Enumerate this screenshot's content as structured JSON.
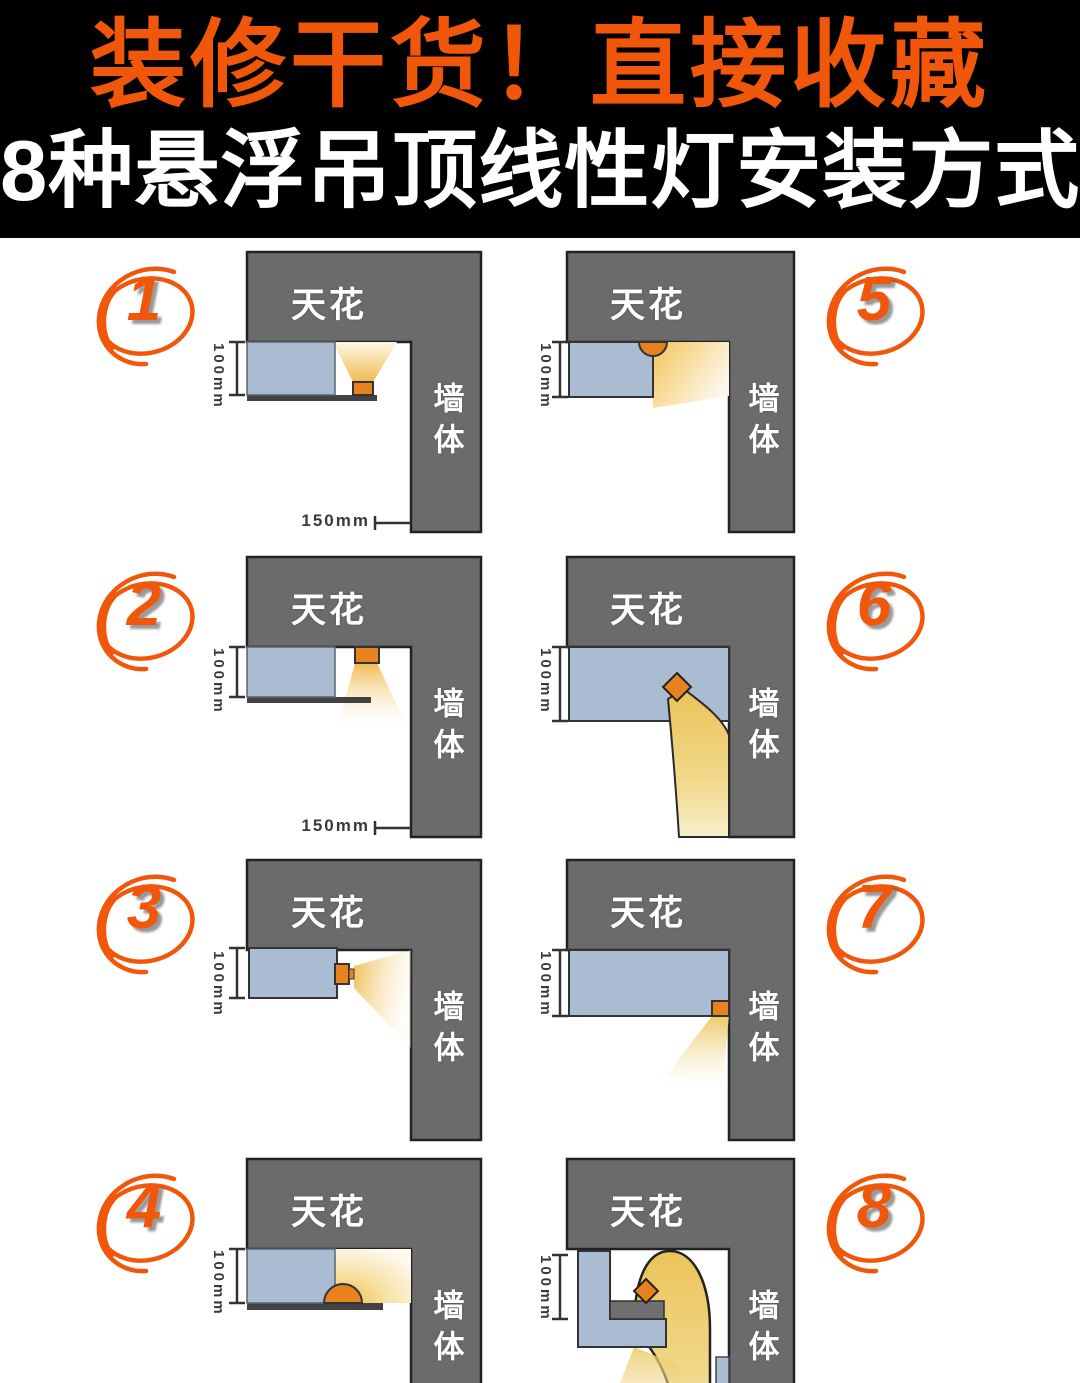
{
  "header": {
    "line1": "装修干货！直接收藏",
    "line2": "8种悬浮吊顶线性灯安装方式"
  },
  "labels": {
    "ceiling": "天花",
    "wall": "墙体",
    "height_dim": "100mm",
    "offset_dim": "150mm"
  },
  "panels": [
    {
      "number": "1"
    },
    {
      "number": "2"
    },
    {
      "number": "3"
    },
    {
      "number": "4"
    },
    {
      "number": "5"
    },
    {
      "number": "6"
    },
    {
      "number": "7"
    },
    {
      "number": "8"
    }
  ],
  "colors": {
    "accent": "#f1570a",
    "gray": "#6b6b6b",
    "blue": "#a9bcd2",
    "orange": "#e8821f",
    "shelf": "#424242",
    "glow": "#f2c55e",
    "header_bg": "#000000",
    "canvas": "#ffffff"
  }
}
